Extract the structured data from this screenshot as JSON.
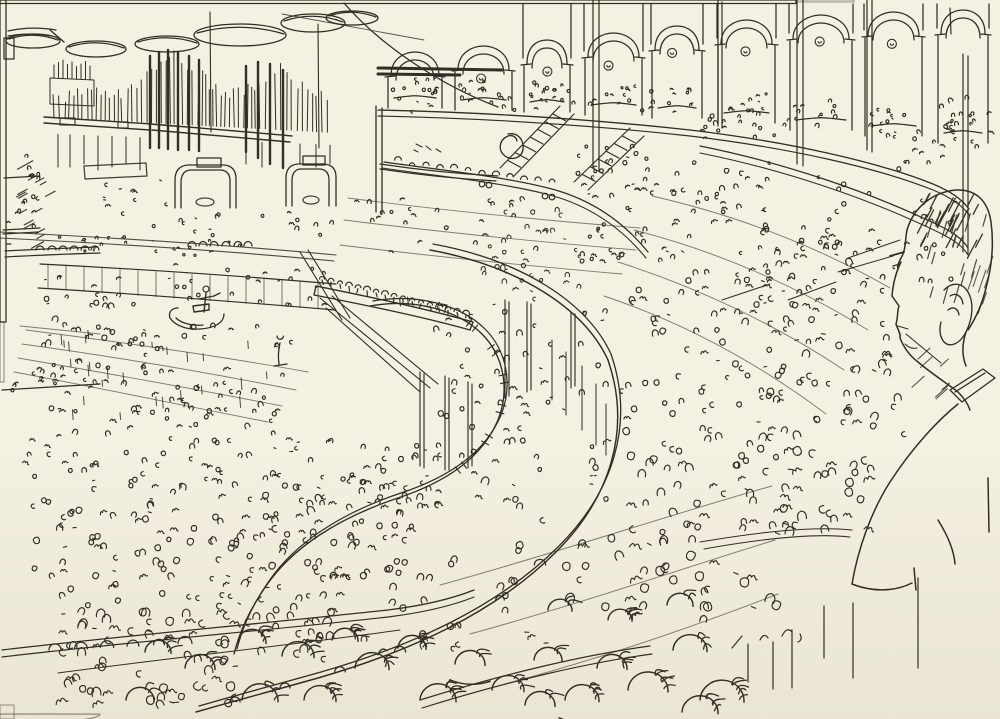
{
  "artwork": {
    "title": "Packed concert hall - pen sketch",
    "description": "Ink sketch looking across a crowded oval concert hall: a pipe organ and arched gallery along the top, hanging disc lamps, a conductor on a podium with orchestra and choir at left, sweeping curved balcony tiers filled with scribbled audience, dense arena crowd below, and the large profile of a spectator's head and shoulder in the right foreground.",
    "medium": "pen and ink on cream sketchbook paper"
  },
  "colors": {
    "paper_top": "#f4f0e2",
    "paper_bottom": "#eae5d3",
    "ink": "#322d26",
    "ink_heavy": "#1d1a14",
    "scan_edge": "#141310",
    "smudge": "#c9c4b2"
  },
  "scene": {
    "regions": [
      {
        "name": "pipe-organ",
        "label": "pipe organ"
      },
      {
        "name": "arched-gallery",
        "label": "arched gallery with standing audience",
        "arches": 9
      },
      {
        "name": "disc-lamps",
        "label": "hanging acoustic disc lamps",
        "count": 6
      },
      {
        "name": "conductor",
        "label": "conductor on podium"
      },
      {
        "name": "orchestra",
        "label": "orchestra and choir rows"
      },
      {
        "name": "balcony-tiers",
        "label": "curved balcony tiers with balusters"
      },
      {
        "name": "staircases",
        "label": "gallery staircases",
        "count": 2
      },
      {
        "name": "arena-crowd",
        "label": "arena floor crowd"
      },
      {
        "name": "stalls-crowd",
        "label": "stalls audience"
      },
      {
        "name": "foreground-heads",
        "label": "large foreground audience heads"
      },
      {
        "name": "spectator-profile",
        "label": "spectator head profile, right foreground"
      }
    ]
  }
}
